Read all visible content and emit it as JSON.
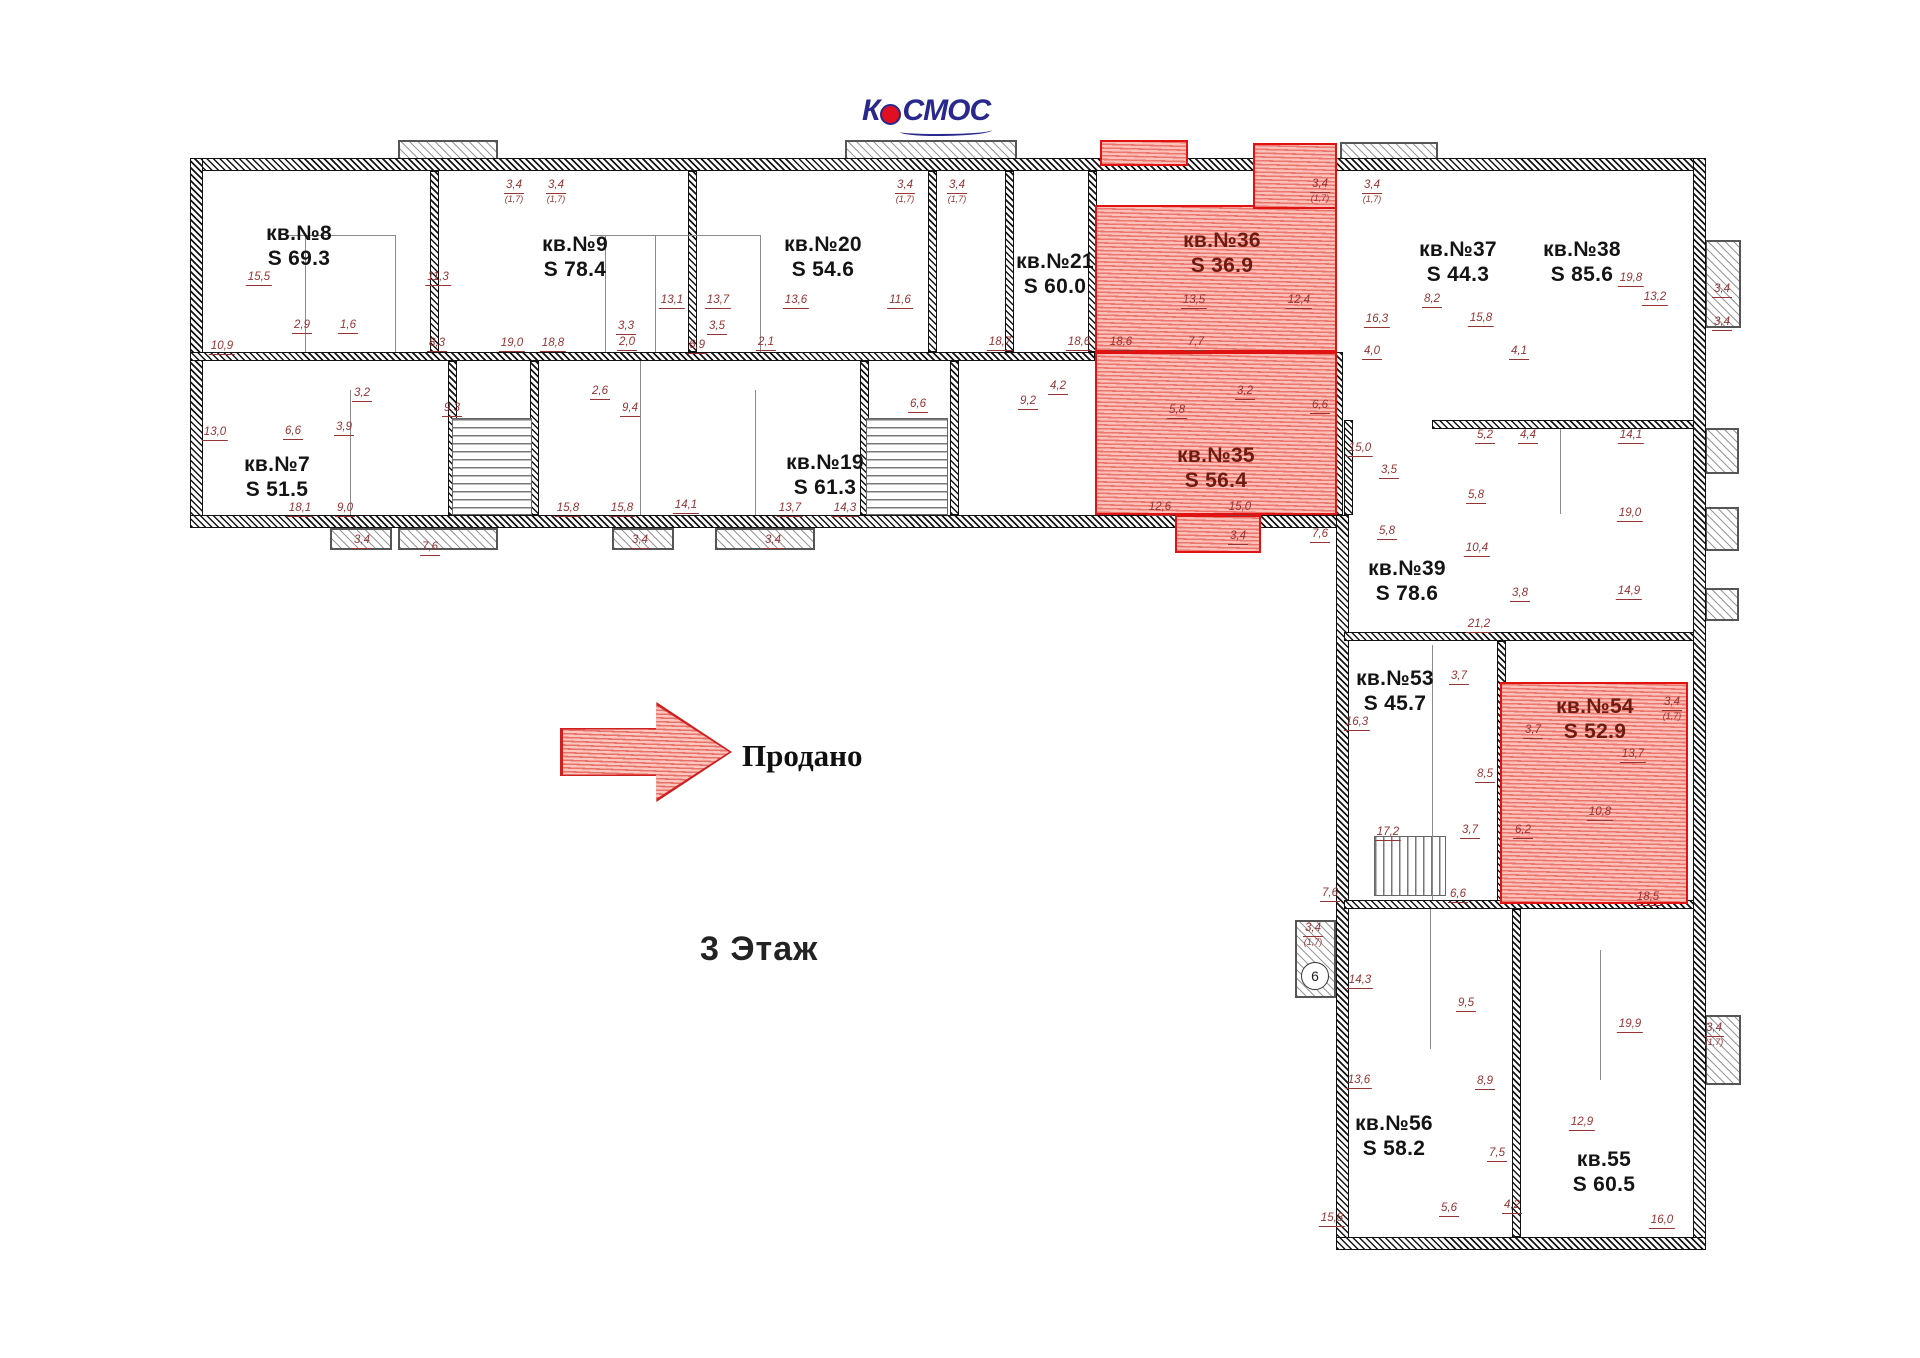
{
  "meta": {
    "floor_title": "3 Этаж",
    "legend_label": "Продано",
    "logo_text_left": "К",
    "logo_text_right": "СМОС"
  },
  "colors": {
    "sold_border": "#e01212",
    "sold_fill": "#f7b9b1",
    "dim_text": "#943434",
    "window_line": "#2e9aa6",
    "logo_blue": "#28288e",
    "logo_red": "#e01020"
  },
  "apartments": [
    {
      "name": "кв.№8",
      "area": "S 69.3",
      "x": 299,
      "y": 246,
      "sold": false
    },
    {
      "name": "кв.№9",
      "area": "S 78.4",
      "x": 575,
      "y": 257,
      "sold": false
    },
    {
      "name": "кв.№20",
      "area": "S 54.6",
      "x": 823,
      "y": 257,
      "sold": false
    },
    {
      "name": "кв.№21",
      "area": "S 60.0",
      "x": 1055,
      "y": 274,
      "sold": false
    },
    {
      "name": "кв.№36",
      "area": "S 36.9",
      "x": 1222,
      "y": 253,
      "sold": true
    },
    {
      "name": "кв.№37",
      "area": "S 44.3",
      "x": 1458,
      "y": 262,
      "sold": false
    },
    {
      "name": "кв.№38",
      "area": "S 85.6",
      "x": 1582,
      "y": 262,
      "sold": false
    },
    {
      "name": "кв.№7",
      "area": "S 51.5",
      "x": 277,
      "y": 477,
      "sold": false
    },
    {
      "name": "кв.№19",
      "area": "S 61.3",
      "x": 825,
      "y": 475,
      "sold": false
    },
    {
      "name": "кв.№35",
      "area": "S 56.4",
      "x": 1216,
      "y": 468,
      "sold": true
    },
    {
      "name": "кв.№39",
      "area": "S 78.6",
      "x": 1407,
      "y": 581,
      "sold": false
    },
    {
      "name": "кв.№53",
      "area": "S 45.7",
      "x": 1395,
      "y": 691,
      "sold": false
    },
    {
      "name": "кв.№54",
      "area": "S 52.9",
      "x": 1595,
      "y": 719,
      "sold": true
    },
    {
      "name": "кв.№56",
      "area": "S 58.2",
      "x": 1394,
      "y": 1136,
      "sold": false
    },
    {
      "name": "кв.55",
      "area": "S 60.5",
      "x": 1604,
      "y": 1172,
      "sold": false
    }
  ],
  "sold_regions": [
    {
      "x": 1095,
      "y": 205,
      "w": 242,
      "h": 147
    },
    {
      "x": 1253,
      "y": 143,
      "w": 84,
      "h": 66
    },
    {
      "x": 1100,
      "y": 140,
      "w": 88,
      "h": 26
    },
    {
      "x": 1095,
      "y": 352,
      "w": 242,
      "h": 163
    },
    {
      "x": 1175,
      "y": 515,
      "w": 86,
      "h": 38
    },
    {
      "x": 1500,
      "y": 682,
      "w": 188,
      "h": 222
    }
  ],
  "walls": [
    {
      "x": 190,
      "y": 158,
      "w": 1515,
      "h": 13
    },
    {
      "x": 190,
      "y": 158,
      "w": 13,
      "h": 370
    },
    {
      "x": 190,
      "y": 515,
      "w": 1158,
      "h": 13
    },
    {
      "x": 1693,
      "y": 158,
      "w": 13,
      "h": 1092
    },
    {
      "x": 1336,
      "y": 515,
      "w": 13,
      "h": 735
    },
    {
      "x": 1336,
      "y": 1237,
      "w": 370,
      "h": 13
    },
    {
      "x": 190,
      "y": 352,
      "w": 905,
      "h": 9
    },
    {
      "x": 430,
      "y": 171,
      "w": 9,
      "h": 181
    },
    {
      "x": 688,
      "y": 171,
      "w": 9,
      "h": 181
    },
    {
      "x": 928,
      "y": 171,
      "w": 9,
      "h": 181
    },
    {
      "x": 1005,
      "y": 171,
      "w": 9,
      "h": 181
    },
    {
      "x": 1088,
      "y": 171,
      "w": 9,
      "h": 181
    },
    {
      "x": 448,
      "y": 361,
      "w": 9,
      "h": 154
    },
    {
      "x": 530,
      "y": 361,
      "w": 9,
      "h": 154
    },
    {
      "x": 860,
      "y": 361,
      "w": 9,
      "h": 154
    },
    {
      "x": 950,
      "y": 361,
      "w": 9,
      "h": 154
    },
    {
      "x": 1330,
      "y": 352,
      "w": 13,
      "h": 163
    },
    {
      "x": 1344,
      "y": 632,
      "w": 350,
      "h": 9
    },
    {
      "x": 1497,
      "y": 641,
      "w": 9,
      "h": 264
    },
    {
      "x": 1344,
      "y": 900,
      "w": 350,
      "h": 9
    },
    {
      "x": 1512,
      "y": 909,
      "w": 9,
      "h": 328
    },
    {
      "x": 1344,
      "y": 420,
      "w": 9,
      "h": 95
    },
    {
      "x": 1432,
      "y": 420,
      "w": 262,
      "h": 9
    }
  ],
  "windows": [
    {
      "x": 203,
      "y": 161,
      "w": 1488,
      "h": 6,
      "dir": "h"
    },
    {
      "x": 191,
      "y": 172,
      "w": 6,
      "h": 344,
      "dir": "v"
    },
    {
      "x": 203,
      "y": 519,
      "w": 1135,
      "h": 6,
      "dir": "h"
    },
    {
      "x": 1697,
      "y": 172,
      "w": 6,
      "h": 1064,
      "dir": "v"
    },
    {
      "x": 1338,
      "y": 530,
      "w": 6,
      "h": 707,
      "dir": "v"
    },
    {
      "x": 1348,
      "y": 1241,
      "w": 345,
      "h": 6,
      "dir": "h"
    }
  ],
  "balconies": [
    {
      "x": 398,
      "y": 140,
      "w": 100,
      "h": 20
    },
    {
      "x": 845,
      "y": 140,
      "w": 172,
      "h": 20
    },
    {
      "x": 1340,
      "y": 142,
      "w": 98,
      "h": 18
    },
    {
      "x": 1705,
      "y": 240,
      "w": 36,
      "h": 88
    },
    {
      "x": 1705,
      "y": 428,
      "w": 34,
      "h": 46
    },
    {
      "x": 1705,
      "y": 507,
      "w": 34,
      "h": 44
    },
    {
      "x": 1705,
      "y": 588,
      "w": 34,
      "h": 33
    },
    {
      "x": 1705,
      "y": 1015,
      "w": 36,
      "h": 70
    },
    {
      "x": 330,
      "y": 528,
      "w": 62,
      "h": 22
    },
    {
      "x": 398,
      "y": 528,
      "w": 100,
      "h": 22
    },
    {
      "x": 612,
      "y": 528,
      "w": 62,
      "h": 22
    },
    {
      "x": 715,
      "y": 528,
      "w": 100,
      "h": 22
    },
    {
      "x": 1295,
      "y": 920,
      "w": 41,
      "h": 78
    }
  ],
  "stairs": [
    {
      "x": 452,
      "y": 418,
      "w": 80,
      "h": 97,
      "dir": "v"
    },
    {
      "x": 866,
      "y": 418,
      "w": 82,
      "h": 97,
      "dir": "v"
    },
    {
      "x": 1264,
      "y": 408,
      "w": 70,
      "h": 107,
      "dir": "v"
    },
    {
      "x": 1374,
      "y": 836,
      "w": 72,
      "h": 60,
      "dir": "h"
    }
  ],
  "partitions": [
    {
      "x": 305,
      "y": 235,
      "w": 1,
      "h": 117
    },
    {
      "x": 395,
      "y": 235,
      "w": 1,
      "h": 117
    },
    {
      "x": 285,
      "y": 235,
      "w": 110,
      "h": 1
    },
    {
      "x": 605,
      "y": 235,
      "w": 1,
      "h": 117
    },
    {
      "x": 655,
      "y": 235,
      "w": 1,
      "h": 117
    },
    {
      "x": 760,
      "y": 235,
      "w": 1,
      "h": 117
    },
    {
      "x": 590,
      "y": 235,
      "w": 170,
      "h": 1
    },
    {
      "x": 350,
      "y": 390,
      "w": 1,
      "h": 125
    },
    {
      "x": 640,
      "y": 361,
      "w": 1,
      "h": 154
    },
    {
      "x": 755,
      "y": 390,
      "w": 1,
      "h": 125
    },
    {
      "x": 1432,
      "y": 645,
      "w": 1,
      "h": 255
    },
    {
      "x": 1560,
      "y": 429,
      "w": 1,
      "h": 85
    },
    {
      "x": 1600,
      "y": 950,
      "w": 1,
      "h": 130
    },
    {
      "x": 1430,
      "y": 909,
      "w": 1,
      "h": 140
    }
  ],
  "entrance": {
    "label": "6",
    "x": 1301,
    "y": 962,
    "d": 28
  },
  "dimensions": [
    {
      "t": "15,5",
      "x": 259,
      "y": 272
    },
    {
      "t": "11,3",
      "x": 438,
      "y": 272
    },
    {
      "t": "10,9",
      "x": 222,
      "y": 341
    },
    {
      "t": "2,9",
      "x": 302,
      "y": 320
    },
    {
      "t": "1,6",
      "x": 348,
      "y": 320
    },
    {
      "t": "8,3",
      "x": 437,
      "y": 338
    },
    {
      "t": "19,0",
      "x": 512,
      "y": 338
    },
    {
      "t": "18,8",
      "x": 553,
      "y": 338
    },
    {
      "t": "2,0",
      "x": 627,
      "y": 337
    },
    {
      "t": "3,3",
      "x": 626,
      "y": 321
    },
    {
      "t": "3,5",
      "x": 717,
      "y": 321
    },
    {
      "t": "2,1",
      "x": 766,
      "y": 337
    },
    {
      "t": "6,9",
      "x": 697,
      "y": 340
    },
    {
      "t": "13,1",
      "x": 672,
      "y": 295
    },
    {
      "t": "13,7",
      "x": 718,
      "y": 295
    },
    {
      "t": "13,6",
      "x": 796,
      "y": 295
    },
    {
      "t": "11,6",
      "x": 900,
      "y": 295
    },
    {
      "t": "18,7",
      "x": 1000,
      "y": 337
    },
    {
      "t": "18,6",
      "x": 1079,
      "y": 337
    },
    {
      "t": "18,6",
      "x": 1121,
      "y": 337
    },
    {
      "t": "7,7",
      "x": 1196,
      "y": 337
    },
    {
      "t": "13,5",
      "x": 1194,
      "y": 295
    },
    {
      "t": "12,4",
      "x": 1299,
      "y": 295
    },
    {
      "t": "9,2",
      "x": 1028,
      "y": 396
    },
    {
      "t": "4,2",
      "x": 1058,
      "y": 381
    },
    {
      "t": "6,6",
      "x": 918,
      "y": 399
    },
    {
      "t": "9,4",
      "x": 630,
      "y": 403
    },
    {
      "t": "2,6",
      "x": 600,
      "y": 386
    },
    {
      "t": "9,3",
      "x": 452,
      "y": 403
    },
    {
      "t": "3,2",
      "x": 362,
      "y": 388
    },
    {
      "t": "3,9",
      "x": 344,
      "y": 422
    },
    {
      "t": "6,6",
      "x": 293,
      "y": 426
    },
    {
      "t": "13,0",
      "x": 215,
      "y": 427
    },
    {
      "t": "18,1",
      "x": 300,
      "y": 503
    },
    {
      "t": "9,0",
      "x": 345,
      "y": 503
    },
    {
      "t": "15,8",
      "x": 568,
      "y": 503
    },
    {
      "t": "15,8",
      "x": 622,
      "y": 503
    },
    {
      "t": "14,1",
      "x": 686,
      "y": 500
    },
    {
      "t": "13,7",
      "x": 790,
      "y": 503
    },
    {
      "t": "14,3",
      "x": 845,
      "y": 503
    },
    {
      "t": "12,6",
      "x": 1160,
      "y": 502
    },
    {
      "t": "15,0",
      "x": 1240,
      "y": 502
    },
    {
      "t": "3,4",
      "x": 1238,
      "y": 531
    },
    {
      "t": "3,2",
      "x": 1245,
      "y": 386
    },
    {
      "t": "5,8",
      "x": 1177,
      "y": 405
    },
    {
      "t": "16,3",
      "x": 1377,
      "y": 314
    },
    {
      "t": "4,0",
      "x": 1372,
      "y": 346
    },
    {
      "t": "8,2",
      "x": 1432,
      "y": 294
    },
    {
      "t": "15,8",
      "x": 1481,
      "y": 313
    },
    {
      "t": "4,1",
      "x": 1519,
      "y": 346
    },
    {
      "t": "19,8",
      "x": 1631,
      "y": 273
    },
    {
      "t": "13,2",
      "x": 1655,
      "y": 292
    },
    {
      "t": "3,4",
      "x": 1722,
      "y": 284
    },
    {
      "t": "3,4",
      "x": 1722,
      "y": 317
    },
    {
      "t": "5,2",
      "x": 1485,
      "y": 430
    },
    {
      "t": "4,4",
      "x": 1528,
      "y": 430
    },
    {
      "t": "14,1",
      "x": 1631,
      "y": 430
    },
    {
      "t": "5,8",
      "x": 1476,
      "y": 490
    },
    {
      "t": "19,0",
      "x": 1630,
      "y": 508
    },
    {
      "t": "14,9",
      "x": 1629,
      "y": 586
    },
    {
      "t": "3,8",
      "x": 1520,
      "y": 588
    },
    {
      "t": "10,4",
      "x": 1477,
      "y": 543
    },
    {
      "t": "6,6",
      "x": 1320,
      "y": 400
    },
    {
      "t": "15,0",
      "x": 1360,
      "y": 443
    },
    {
      "t": "3,5",
      "x": 1389,
      "y": 465
    },
    {
      "t": "5,8",
      "x": 1387,
      "y": 526
    },
    {
      "t": "7,6",
      "x": 1320,
      "y": 529
    },
    {
      "t": "21,2",
      "x": 1479,
      "y": 619
    },
    {
      "t": "16,3",
      "x": 1357,
      "y": 717
    },
    {
      "t": "3,7",
      "x": 1459,
      "y": 671
    },
    {
      "t": "8,5",
      "x": 1485,
      "y": 769
    },
    {
      "t": "17,2",
      "x": 1388,
      "y": 827
    },
    {
      "t": "3,7",
      "x": 1470,
      "y": 825
    },
    {
      "t": "6,2",
      "x": 1523,
      "y": 825
    },
    {
      "t": "3,7",
      "x": 1533,
      "y": 725
    },
    {
      "t": "13,7",
      "x": 1633,
      "y": 749
    },
    {
      "t": "3,4",
      "x": 1672,
      "y": 697,
      "sub": "(1,7)"
    },
    {
      "t": "10,8",
      "x": 1600,
      "y": 807
    },
    {
      "t": "18,5",
      "x": 1648,
      "y": 892
    },
    {
      "t": "7,6",
      "x": 1330,
      "y": 888
    },
    {
      "t": "6,6",
      "x": 1458,
      "y": 889
    },
    {
      "t": "3,4",
      "x": 1313,
      "y": 923,
      "sub": "(1,7)"
    },
    {
      "t": "14,3",
      "x": 1360,
      "y": 975
    },
    {
      "t": "9,5",
      "x": 1466,
      "y": 998
    },
    {
      "t": "13,6",
      "x": 1359,
      "y": 1075
    },
    {
      "t": "8,9",
      "x": 1485,
      "y": 1076
    },
    {
      "t": "19,9",
      "x": 1630,
      "y": 1019
    },
    {
      "t": "3,4",
      "x": 1714,
      "y": 1023,
      "sub": "(1,7)"
    },
    {
      "t": "12,9",
      "x": 1582,
      "y": 1117
    },
    {
      "t": "7,5",
      "x": 1497,
      "y": 1148
    },
    {
      "t": "5,6",
      "x": 1449,
      "y": 1203
    },
    {
      "t": "4,2",
      "x": 1512,
      "y": 1200
    },
    {
      "t": "15,8",
      "x": 1332,
      "y": 1213
    },
    {
      "t": "16,0",
      "x": 1662,
      "y": 1215
    },
    {
      "t": "3,4",
      "x": 514,
      "y": 180,
      "sub": "(1,7)"
    },
    {
      "t": "3,4",
      "x": 556,
      "y": 180,
      "sub": "(1,7)"
    },
    {
      "t": "3,4",
      "x": 905,
      "y": 180,
      "sub": "(1,7)"
    },
    {
      "t": "3,4",
      "x": 957,
      "y": 180,
      "sub": "(1,7)"
    },
    {
      "t": "3,4",
      "x": 1320,
      "y": 179,
      "sub": "(1,7)"
    },
    {
      "t": "3,4",
      "x": 1372,
      "y": 180,
      "sub": "(1,7)"
    },
    {
      "t": "3,4",
      "x": 362,
      "y": 535
    },
    {
      "t": "7,6",
      "x": 430,
      "y": 542
    },
    {
      "t": "3,4",
      "x": 640,
      "y": 535
    },
    {
      "t": "3,4",
      "x": 773,
      "y": 535
    }
  ]
}
